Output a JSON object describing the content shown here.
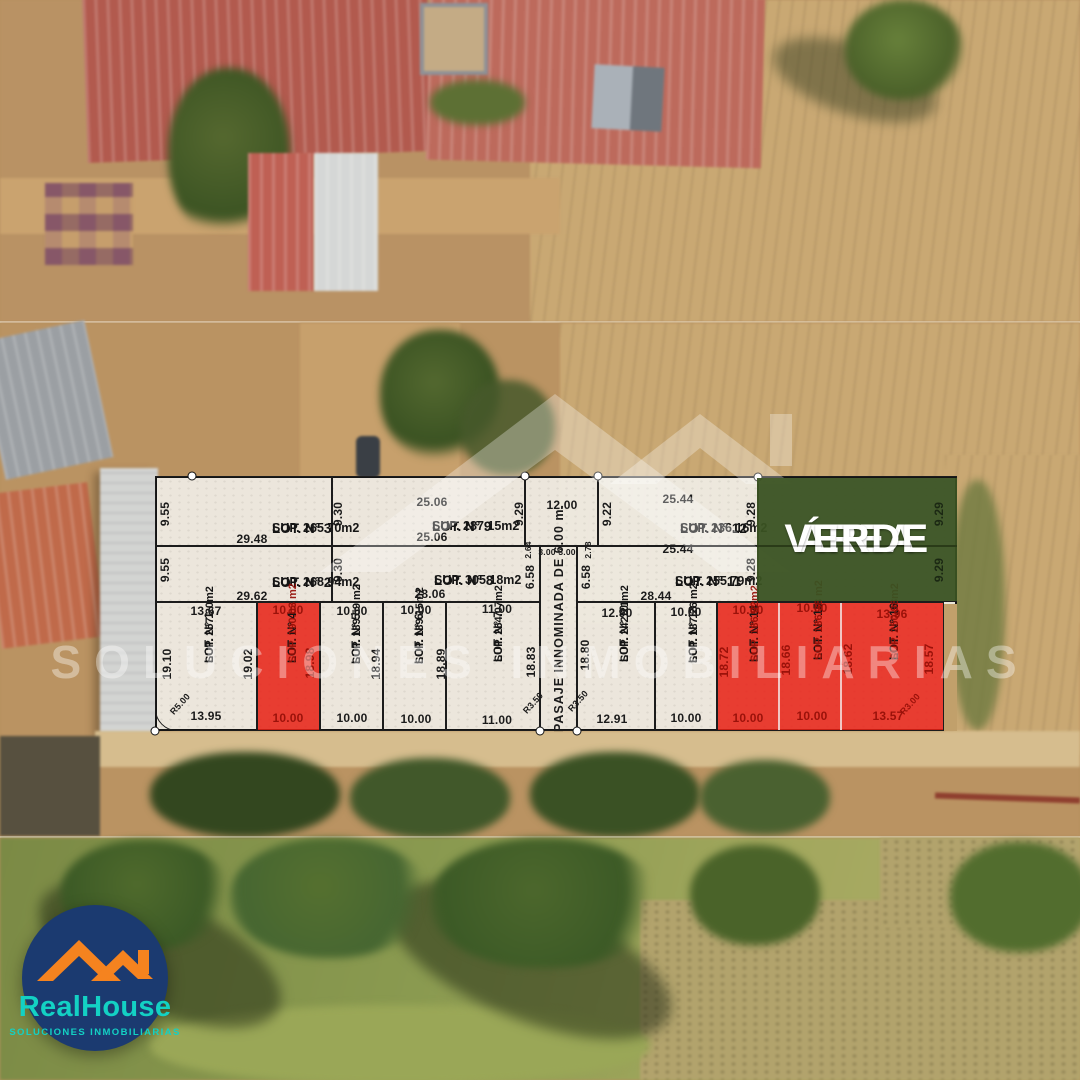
{
  "area_verde": {
    "line1": "ÁREA",
    "line2": "VERDE",
    "bg_color": "#3a5222"
  },
  "pasaje": {
    "label": "PASAJE INNOMINADA DE 6.00 m."
  },
  "lots": [
    {
      "n": "LOT. N° 1",
      "sup": "SUP. 257.20m2",
      "highlight": "none"
    },
    {
      "n": "LOT. N° 2",
      "sup": "SUP. 268.94m2",
      "highlight": "none"
    },
    {
      "n": "LOT. N° 3",
      "sup": "SUP. 265.70m2",
      "highlight": "none"
    },
    {
      "n": "LOT. N° 4",
      "sup": "SUP. 190.03 m2",
      "highlight": "red"
    },
    {
      "n": "LOT. N° 5",
      "sup": "SUP. 189.59 m2",
      "highlight": "none"
    },
    {
      "n": "LOT. N° 6",
      "sup": "SUP. 189.15m2",
      "highlight": "none"
    },
    {
      "n": "LOT. N° 7",
      "sup": "SUP. 264.07m2",
      "highlight": "none"
    },
    {
      "n": "LOT. N° 8",
      "sup": "SUP. 305.18m2",
      "highlight": "none"
    },
    {
      "n": "LOT. N° 9",
      "sup": "SUP. 287.15m2",
      "highlight": "none"
    },
    {
      "n": "LOT. N° 10",
      "sup": "SUP. 242.21m2",
      "highlight": "none"
    },
    {
      "n": "LOT. N° 11",
      "sup": "SUP. 255.79m2",
      "highlight": "none"
    },
    {
      "n": "LOT. N° 12",
      "sup": "SUP. 236.16m2",
      "highlight": "none"
    },
    {
      "n": "LOT. N° 13",
      "sup": "SUP. 187.26 m2",
      "highlight": "none"
    },
    {
      "n": "LOT. N° 14",
      "sup": "SUP. 186.92m2",
      "highlight": "red"
    },
    {
      "n": "LOT. N° 15",
      "sup": "SUP. 186.38 m2",
      "highlight": "red"
    },
    {
      "n": "LOT. N° 16",
      "sup": "SUP. 250.98m2",
      "highlight": "red"
    }
  ],
  "dims": {
    "lot9_top": "25.06",
    "pasaje_top": "12.00",
    "lot12_top": "25.44",
    "lot3_bottom": "29.48",
    "lot2_bottom": "29.62",
    "lot9_bottom": "25.06",
    "lot12_bottom": "25.44",
    "lot8_bottom": "28.06",
    "lot11_bottom": "28.44",
    "lot3_left": "9.55",
    "lot2_left": "9.55",
    "lot3_right": "9.30",
    "lot2_right": "9.30",
    "lot9_right": "9.29",
    "lot12_left": "9.22",
    "lot12_right": "9.28",
    "lot11_right": "9.28",
    "green_right_top": "9.29",
    "green_right_bottom": "9.29",
    "lot8_right": "6.58",
    "lot11_left": "6.58",
    "jog_left_v": "2.64",
    "jog_left_h": "3.00",
    "jog_right_h": "3.00",
    "jog_right_v": "2.78",
    "lot1_top": "13.67",
    "lot1_left": "19.10",
    "lot1_right": "19.02",
    "lot1_bottom": "13.95",
    "lot1_corner": "R5.00",
    "lot4_top": "10.00",
    "lot4_bottom": "10.00",
    "lot4_side": "18.98",
    "lot5_top": "10.00",
    "lot5_bottom": "10.00",
    "lot5_side": "18.94",
    "lot6_top": "10.00",
    "lot6_bottom": "10.00",
    "lot6_side": "18.89",
    "lot7_top": "11.00",
    "lot7_bottom": "11.00",
    "lot7_side": "18.83",
    "pasaje_corner_left": "R3.50",
    "pasaje_corner_right": "R3.50",
    "lot10_top": "12.90",
    "lot10_bottom": "12.91",
    "lot10_side": "18.80",
    "lot13_top": "10.00",
    "lot13_bottom": "10.00",
    "lot14_top": "10.00",
    "lot14_bottom": "10.00",
    "lot14_side": "18.72",
    "lot15_top": "10.00",
    "lot15_bottom": "10.00",
    "lot15_side": "18.66",
    "lot16_top": "13.96",
    "lot16_bottom": "13.57",
    "lot16_left": "18.62",
    "lot16_right": "18.57",
    "lot16_corner": "R3.00"
  },
  "colors": {
    "sold_red": "#e81e13",
    "green_area": "#3a5222",
    "logo_navy": "#1b3a70",
    "logo_teal": "#13d1c4",
    "logo_orange": "#f5831f"
  },
  "logo": {
    "brand": "RealHouse",
    "tagline": "SOLUCIONES INMOBILIARIAS"
  },
  "watermark": {
    "tagline": "SOLUCIONES INMOBILIARIAS"
  }
}
